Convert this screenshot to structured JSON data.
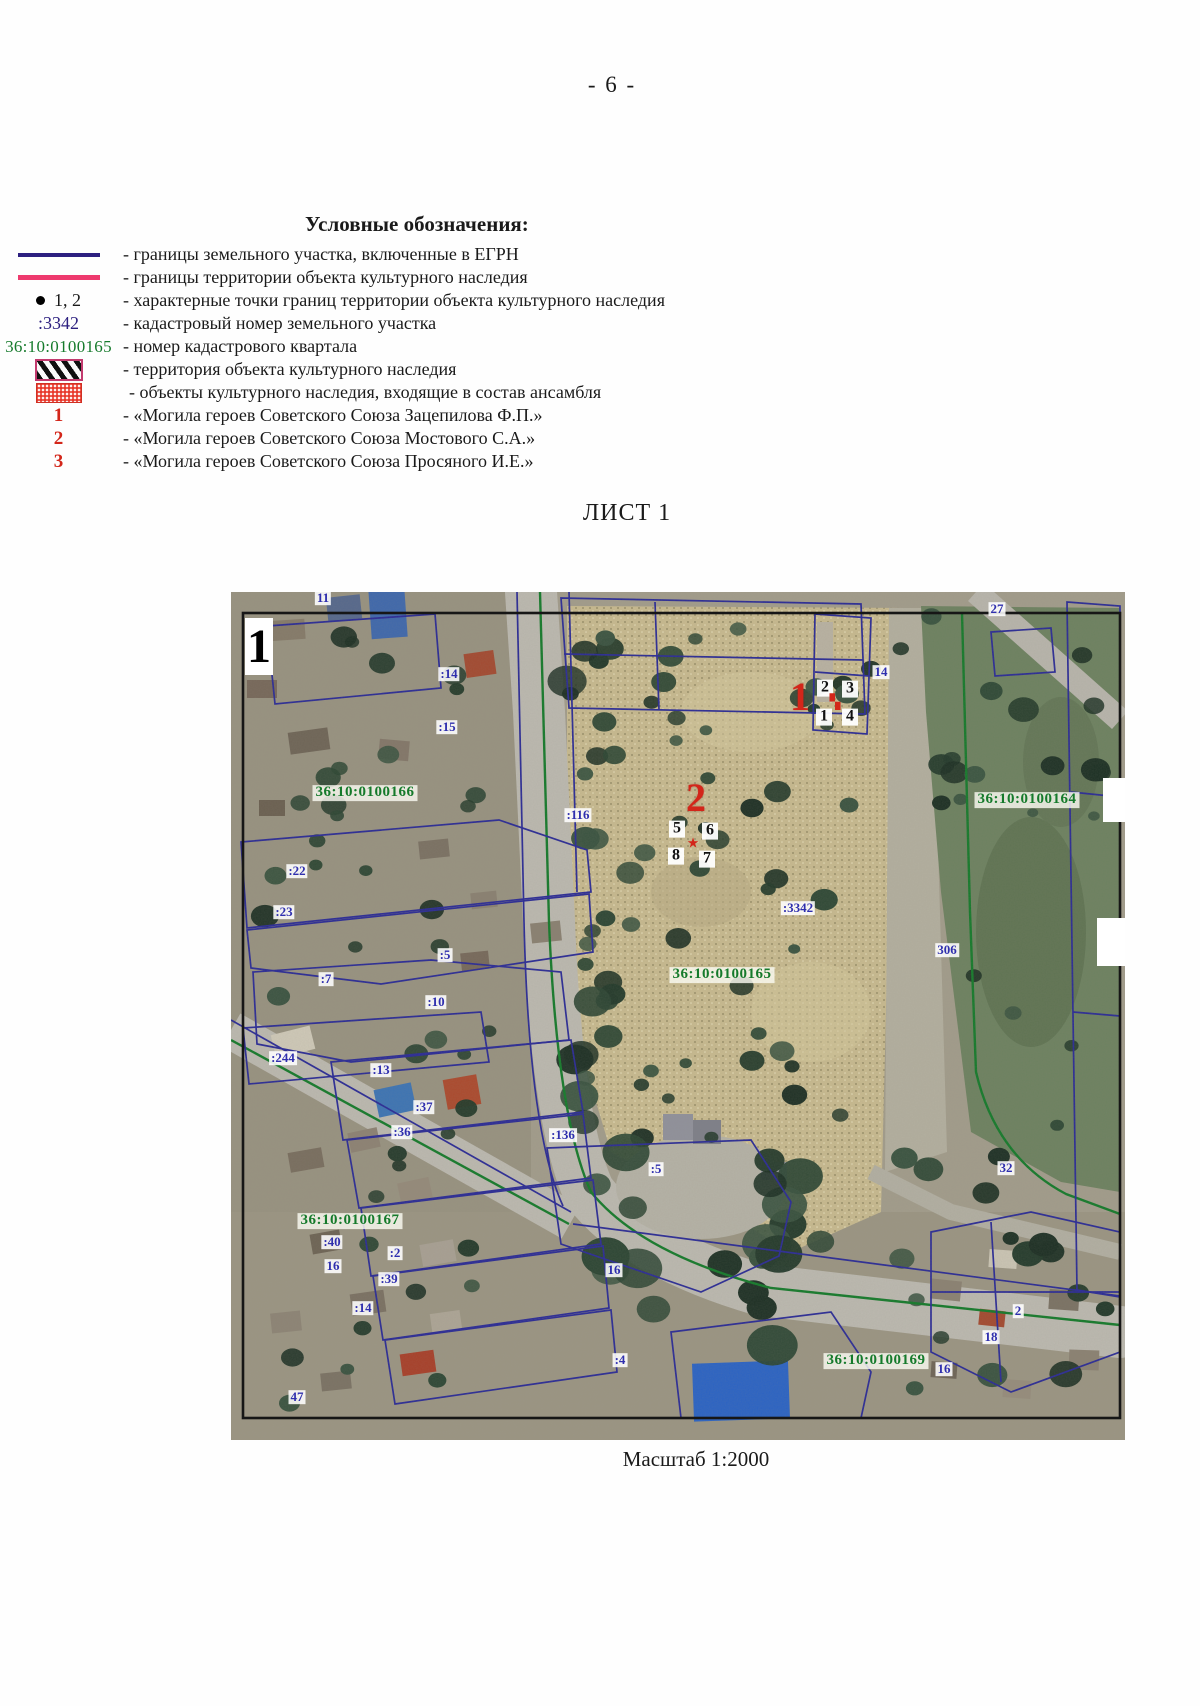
{
  "page": {
    "number": "- 6 -"
  },
  "legend": {
    "title": "Условные обозначения:",
    "items": [
      {
        "symbol": "egrn-line",
        "label": "- границы земельного участка, включенные в ЕГРН"
      },
      {
        "symbol": "heritage-line",
        "label": "- границы территории объекта культурного наследия"
      },
      {
        "symbol": "boundary-point",
        "symbol_text": "1, 2",
        "label": "- характерные точки границ территории объекта культурного наследия"
      },
      {
        "symbol": "cadastral-number",
        "symbol_text": ":3342",
        "label": "- кадастровый номер земельного участка"
      },
      {
        "symbol": "quarter-number",
        "symbol_text": "36:10:0100165",
        "label": "- номер кадастрового квартала"
      },
      {
        "symbol": "hatch-swatch",
        "label": "- территория объекта культурного наследия"
      },
      {
        "symbol": "dotted-swatch",
        "label": "- объекты культурного наследия, входящие в состав ансамбля"
      },
      {
        "symbol": "red-number",
        "symbol_text": "1",
        "label": "- «Могила героев Советского Союза Зацепилова Ф.П.»"
      },
      {
        "symbol": "red-number",
        "symbol_text": "2",
        "label": "- «Могила героев Советского Союза Мостового С.А.»"
      },
      {
        "symbol": "red-number",
        "symbol_text": "3",
        "label": "- «Могила героев Советского Союза Просяного И.Е.»"
      }
    ]
  },
  "sheet": {
    "title": "ЛИСТ 1",
    "scale": "Масштаб 1:2000"
  },
  "map": {
    "corner_number": "1",
    "labels": [
      {
        "t": "11",
        "x": 92,
        "y": 6,
        "k": "parcel"
      },
      {
        "t": ":14",
        "x": 218,
        "y": 82,
        "k": "parcel"
      },
      {
        "t": ":15",
        "x": 216,
        "y": 135,
        "k": "parcel"
      },
      {
        "t": "14",
        "x": 650,
        "y": 80,
        "k": "parcel"
      },
      {
        "t": ":22",
        "x": 66,
        "y": 279,
        "k": "parcel"
      },
      {
        "t": ":23",
        "x": 53,
        "y": 320,
        "k": "parcel"
      },
      {
        "t": ":7",
        "x": 95,
        "y": 387,
        "k": "parcel"
      },
      {
        "t": ":5",
        "x": 214,
        "y": 363,
        "k": "parcel"
      },
      {
        "t": ":10",
        "x": 205,
        "y": 410,
        "k": "parcel"
      },
      {
        "t": ":244",
        "x": 52,
        "y": 466,
        "k": "parcel"
      },
      {
        "t": ":13",
        "x": 150,
        "y": 478,
        "k": "parcel"
      },
      {
        "t": ":37",
        "x": 193,
        "y": 515,
        "k": "parcel"
      },
      {
        "t": ":36",
        "x": 171,
        "y": 540,
        "k": "parcel"
      },
      {
        "t": ":2",
        "x": 164,
        "y": 661,
        "k": "parcel"
      },
      {
        "t": ":39",
        "x": 158,
        "y": 687,
        "k": "parcel"
      },
      {
        "t": ":14",
        "x": 132,
        "y": 716,
        "k": "parcel"
      },
      {
        "t": ":40",
        "x": 101,
        "y": 650,
        "k": "parcel"
      },
      {
        "t": "16",
        "x": 102,
        "y": 674,
        "k": "parcel"
      },
      {
        "t": "47",
        "x": 66,
        "y": 805,
        "k": "parcel"
      },
      {
        "t": ":116",
        "x": 347,
        "y": 223,
        "k": "parcel"
      },
      {
        "t": ":136",
        "x": 332,
        "y": 543,
        "k": "parcel"
      },
      {
        "t": ":5",
        "x": 425,
        "y": 577,
        "k": "parcel"
      },
      {
        "t": ":3342",
        "x": 567,
        "y": 316,
        "k": "parcel"
      },
      {
        "t": "27",
        "x": 766,
        "y": 17,
        "k": "parcel"
      },
      {
        "t": "306",
        "x": 716,
        "y": 358,
        "k": "parcel"
      },
      {
        "t": "32",
        "x": 775,
        "y": 576,
        "k": "parcel"
      },
      {
        "t": "16",
        "x": 383,
        "y": 678,
        "k": "parcel"
      },
      {
        "t": "2",
        "x": 787,
        "y": 719,
        "k": "parcel"
      },
      {
        "t": "18",
        "x": 760,
        "y": 745,
        "k": "parcel"
      },
      {
        "t": ":4",
        "x": 389,
        "y": 768,
        "k": "parcel"
      },
      {
        "t": "16",
        "x": 713,
        "y": 777,
        "k": "parcel"
      },
      {
        "t": "36:10:0100166",
        "x": 134,
        "y": 201,
        "k": "quarter"
      },
      {
        "t": "36:10:0100164",
        "x": 796,
        "y": 208,
        "k": "quarter"
      },
      {
        "t": "36:10:0100165",
        "x": 491,
        "y": 383,
        "k": "quarter"
      },
      {
        "t": "36:10:0100167",
        "x": 119,
        "y": 629,
        "k": "quarter"
      },
      {
        "t": "36:10:0100169",
        "x": 645,
        "y": 769,
        "k": "quarter"
      },
      {
        "t": "1",
        "x": 569,
        "y": 105,
        "k": "marker"
      },
      {
        "t": "2",
        "x": 465,
        "y": 206,
        "k": "marker"
      },
      {
        "t": "2",
        "x": 594,
        "y": 96,
        "k": "point"
      },
      {
        "t": "3",
        "x": 619,
        "y": 97,
        "k": "point"
      },
      {
        "t": "1",
        "x": 593,
        "y": 125,
        "k": "point"
      },
      {
        "t": "4",
        "x": 619,
        "y": 125,
        "k": "point"
      },
      {
        "t": "5",
        "x": 446,
        "y": 237,
        "k": "point"
      },
      {
        "t": "6",
        "x": 479,
        "y": 239,
        "k": "point"
      },
      {
        "t": "8",
        "x": 445,
        "y": 264,
        "k": "point"
      },
      {
        "t": "7",
        "x": 476,
        "y": 267,
        "k": "point"
      },
      {
        "t": "★",
        "x": 462,
        "y": 253,
        "k": "special"
      },
      {
        "t": "▚",
        "x": 604,
        "y": 112,
        "k": "special"
      }
    ]
  },
  "colors": {
    "egrn_line": "#2d2080",
    "heritage_line": "#ee3a6e",
    "quarter_green": "#157a2b",
    "parcel_blue": "#2f2fae",
    "heritage_red": "#d3261a"
  }
}
